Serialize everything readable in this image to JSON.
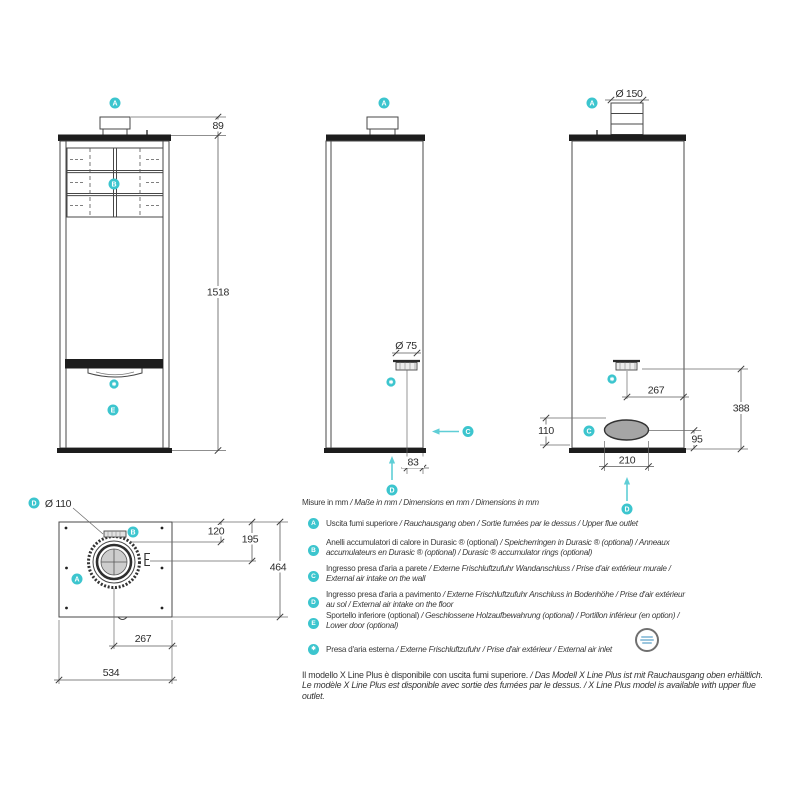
{
  "colors": {
    "accent_teal": "#3cc5ce",
    "line": "#474747",
    "oval_fill": "#a5a5a5"
  },
  "markers": {
    "a": "A",
    "b": "B",
    "c": "C",
    "d": "D",
    "e": "E",
    "star": "✱"
  },
  "dimensions": {
    "front": {
      "flue_height": "89",
      "total_height": "1518"
    },
    "side": {
      "air_inlet_diameter": "Ø 75",
      "air_inlet_offset": "83"
    },
    "back": {
      "flue_diameter": "Ø 150",
      "air_inlet_from_side": "267",
      "air_inlet_height": "388",
      "recess_height_left": "110",
      "recess_height_right": "95",
      "recess_width": "210"
    },
    "top": {
      "air_inlet_diameter": "Ø 110",
      "flue_from_back": "120",
      "flue_center": "195",
      "depth": "464",
      "inlet_from_side": "267",
      "width": "534"
    }
  },
  "legend": {
    "units": {
      "regular": "Misure in mm",
      "italic": " / Maße in mm / Dimensions en mm / Dimensions in mm"
    },
    "items": [
      {
        "marker": "A",
        "regular": "Uscita fumi superiore",
        "italic": " / Rauchausgang oben / Sortie fumées par le dessus / Upper flue outlet"
      },
      {
        "marker": "B",
        "regular": "Anelli accumulatori di calore in Durasic ® (optional)",
        "italic": " / Speicherringen in Durasic ® (optional) / Anneaux accumulateurs en Durasic ® (optional) / Durasic ® accumulator rings (optional)"
      },
      {
        "marker": "C",
        "regular": "Ingresso presa d'aria a parete",
        "italic": " / Externe Frischluftzufuhr Wandanschluss / Prise d'air extérieur murale / External air intake on the wall"
      },
      {
        "marker": "D",
        "regular": "Ingresso presa d'aria a pavimento",
        "italic": " / Externe Frischluftzufuhr Anschluss in Bodenhöhe / Prise d'air extérieur au sol / External air intake on the floor"
      },
      {
        "marker": "E",
        "regular": "Sportello inferiore (optional)",
        "italic": " / Geschlossene Holzaufbewahrung (optional) / Portillon inférieur (en option) / Lower door (optional)"
      },
      {
        "marker": "✱",
        "regular": "Presa d'aria esterna",
        "italic": " / Externe Frischluftzufuhr / Prise d'air extérieur / External air inlet"
      }
    ]
  },
  "footer": {
    "line1_regular": "Il modello X Line Plus è disponibile con uscita fumi superiore.",
    "line1_italic": " / Das Modell X Line Plus ist mit Rauchausgang oben erhältlich.",
    "line2_italic": "Le modèle X Line Plus est disponible avec sortie des fumées par le dessus. / X Line Plus model is available with upper flue outlet."
  }
}
